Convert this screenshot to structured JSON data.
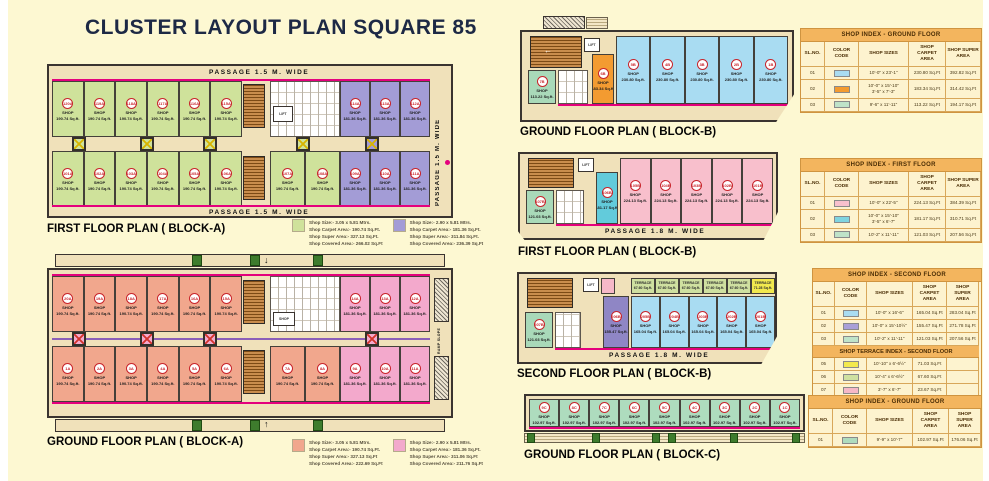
{
  "page": {
    "title": "CLUSTER LAYOUT PLAN SQUARE 85"
  },
  "labels": {
    "shop_word": "SHOP",
    "terrace_word": "TERRACE",
    "lift": "LIFT",
    "arrow_down": "↓",
    "arrow_up": "↑",
    "arrow_left": "←"
  },
  "colors": {
    "green_a": "#cfe29b",
    "purple_a": "#a39cd6",
    "salmon": "#f1a78d",
    "pink_a": "#f3a9cc",
    "blue_b": "#a9dcf2",
    "orange_b": "#f39b31",
    "mint": "#a9d9b9",
    "pink_b": "#f8bfcc",
    "cyan_b": "#62cbdb",
    "purple_b": "#8f86c5",
    "terr_green": "#cfe0a0",
    "terr_yellow": "#f2e94e",
    "terr_pink": "#f6b8c8",
    "mint_c": "#aedcbe",
    "magenta": "#e4007d"
  },
  "plans": {
    "first_a": {
      "label": "FIRST FLOOR PLAN ( BLOCK-A)",
      "passage_top": "PASSAGE 1.5 M. WIDE",
      "passage_bottom": "PASSAGE 1.5 M. WIDE",
      "passage_side": "PASSAGE 1.5 M. WIDE",
      "green_top": [
        "120A",
        "119A",
        "118A",
        "117A",
        "116A",
        "115A"
      ],
      "green_bottom": [
        "101A",
        "102A",
        "103A",
        "104A",
        "105A",
        "106A"
      ],
      "green_mid": [
        "107A",
        "108A"
      ],
      "purple_top": [
        "114A",
        "113A",
        "112A"
      ],
      "purple_bottom": [
        "109A",
        "110A",
        "111A"
      ],
      "green_area": "190.74 Sq.ft.",
      "purple_area": "181.36 Sq.ft."
    },
    "ground_a": {
      "label": "GROUND FLOOR PLAN ( BLOCK-A)",
      "salmon_top": [
        "20A",
        "19A",
        "18A",
        "17A",
        "16A",
        "15A"
      ],
      "salmon_bottom": [
        "1A",
        "2A",
        "3A",
        "4A",
        "5A",
        "6A"
      ],
      "salmon_mid": [
        "7A",
        "8A"
      ],
      "pink_top": [
        "14A",
        "13A",
        "12A"
      ],
      "pink_bottom": [
        "9A",
        "10A",
        "11A"
      ],
      "salmon_area": "190.74 Sq.ft.",
      "pink_area": "181.36 Sq.ft.",
      "small_shop_label": "SHOP",
      "ramp_label": "RAMP SLOPE"
    },
    "ground_b": {
      "label": "GROUND FLOOR PLAN ( BLOCK-B)",
      "mint_shop": {
        "id": "7B",
        "area": "113.22 Sq.ft."
      },
      "orange_shop": {
        "id": "6B",
        "area": "183.34 Sq.ft."
      },
      "blue_shops": [
        "5B",
        "4B",
        "3B",
        "2B",
        "1B"
      ],
      "blue_area": "230.80 Sq.ft."
    },
    "first_b": {
      "label": "FIRST FLOOR PLAN ( BLOCK-B)",
      "passage": "PASSAGE 1.8 M. WIDE",
      "mint_shop": {
        "id": "107B",
        "area": "121.03 Sq.ft."
      },
      "cyan_shop": {
        "id": "106B",
        "area": "181.17 Sq.ft."
      },
      "pink_shops": [
        "105B",
        "104B",
        "103B",
        "102B",
        "101B"
      ],
      "pink_area": "224.13 Sq.ft."
    },
    "second_b": {
      "label": "SECOND FLOOR PLAN ( BLOCK-B)",
      "passage": "PASSAGE 1.8 M. WIDE",
      "mint_shop": {
        "id": "207B",
        "area": "121.03 Sq.ft."
      },
      "purple_shop": {
        "id": "206B",
        "area": "155.47 Sq.ft."
      },
      "blue_shops": [
        "205B",
        "204B",
        "203B",
        "202B",
        "201B"
      ],
      "blue_area": "165.04 Sq.ft.",
      "terrace_area": "67.60 Sq.ft.",
      "terrace_yellow_area": "71.28 Sq.ft."
    },
    "ground_c": {
      "label": "GROUND FLOOR PLAN ( BLOCK-C)",
      "shops": [
        "9C",
        "8C",
        "7C",
        "6C",
        "5C",
        "4C",
        "3C",
        "2C",
        "1C"
      ],
      "area": "102.97 Sq.ft."
    }
  },
  "legends": {
    "first_a": [
      {
        "swatch": "#cfe29b",
        "lines": [
          "Shop Size:- 3.05 x 5.81 Mtrs.",
          "Shop Carpet Area:- 190.74 Sq.Ft.",
          "Shop Super Area:- 327.13 Sq.Ft.",
          "Shop Covered Area:- 266.02 Sq.Ft"
        ]
      },
      {
        "swatch": "#a39cd6",
        "lines": [
          "Shop Size:- 2.90 x 5.81 Mtrs.",
          "Shop Carpet Area:- 181.36 Sq.Ft.",
          "Shop Super Area:- 311.84 Sq.Ft.",
          "Shop Covered Area:- 236.39 Sq.Ft"
        ]
      }
    ],
    "ground_a": [
      {
        "swatch": "#f1a78d",
        "lines": [
          "Shop Size:- 3.05 x 5.81 Mtrs.",
          "Shop Carpet Area:- 190.74 Sq.Ft.",
          "Shop Super Area:- 327.13 Sq.Ft",
          "Shop Covered Area:- 222.69 Sq.Ft"
        ]
      },
      {
        "swatch": "#f3a9cc",
        "lines": [
          "Shop Size:- 2.90 x 5.81 Mtrs.",
          "Shop Carpet Area:- 181.36 Sq.Ft.",
          "Shop Super Area:- 311.06 Sq.Ft",
          "Shop Covered Area:- 211.76 Sq.Ft"
        ]
      }
    ]
  },
  "tables": [
    {
      "id": "tbl1",
      "title": "SHOP INDEX - GROUND FLOOR",
      "headers": [
        "SL.NO.",
        "COLOR CODE",
        "SHOP SIZES",
        "SHOP CARPET AREA",
        "SHOP SUPER AREA"
      ],
      "rows": [
        {
          "no": "01",
          "swatch": "#a9dcf2",
          "size": "10'-0\" x 23'-1\"",
          "carpet": "230.80 Sq.Ft",
          "super": "392.82 Sq.Ft"
        },
        {
          "no": "02",
          "swatch": "#f39b31",
          "size": "10'-0\" x 15'-10\"\n3'-5\" x 7'-3\"",
          "carpet": "183.34 Sq.Ft",
          "super": "314.42 Sq.Ft"
        },
        {
          "no": "03",
          "swatch": "#bfe3c9",
          "size": "9'-6\" x 11'-11\"",
          "carpet": "113.22 Sq.Ft",
          "super": "194.17 Sq.Ft"
        }
      ]
    },
    {
      "id": "tbl2",
      "title": "SHOP INDEX - FIRST FLOOR",
      "headers": [
        "SL.NO.",
        "COLOR CODE",
        "SHOP SIZES",
        "SHOP CARPET AREA",
        "SHOP SUPER AREA"
      ],
      "rows": [
        {
          "no": "01",
          "swatch": "#f8c0cd",
          "size": "10'-0\" x 22'-5\"",
          "carpet": "224.13 Sq.Ft",
          "super": "384.39 Sq.Ft"
        },
        {
          "no": "02",
          "swatch": "#7fd4e0",
          "size": "10'-0\" x 15'-10\"\n3'-5\" x 6'-7\"",
          "carpet": "181.17 Sq.Ft",
          "super": "310.71 Sq.Ft"
        },
        {
          "no": "03",
          "swatch": "#bfe3c9",
          "size": "10'-2\" x 11'-11\"",
          "carpet": "121.03 Sq.Ft",
          "super": "207.56 Sq.Ft"
        }
      ]
    },
    {
      "id": "tbl3",
      "title": "SHOP INDEX - SECOND FLOOR",
      "headers": [
        "SL.NO.",
        "COLOR CODE",
        "SHOP SIZES",
        "SHOP CARPET AREA",
        "SHOP SUPER AREA"
      ],
      "rows": [
        {
          "no": "01",
          "swatch": "#a9dcf2",
          "size": "10'-0\" x 16'-6\"",
          "carpet": "165.04 Sq.Ft",
          "super": "283.04 Sq.Ft"
        },
        {
          "no": "02",
          "swatch": "#a9a0d8",
          "size": "10'-0\" x 15'-10½\"",
          "carpet": "155.47 Sq.Ft",
          "super": "271.78 Sq.Ft"
        },
        {
          "no": "03",
          "swatch": "#bfe3c9",
          "size": "10'-2\" x 11'-11\"",
          "carpet": "121.03 Sq.Ft",
          "super": "207.56 Sq.Ft"
        },
        {
          "subheader": "SHOP TERRACE INDEX - SECOND FLOOR"
        },
        {
          "no": "05",
          "swatch": "#f2e94e",
          "size": "10'-10\" x 6'-6½\"",
          "carpet": "71.03 Sq.Ft",
          "super": ""
        },
        {
          "no": "06",
          "swatch": "#cfe0a0",
          "size": "10'-4\" x 6'-6½\"",
          "carpet": "67.60 Sq.Ft",
          "super": ""
        },
        {
          "no": "07",
          "swatch": "#f6b8c8",
          "size": "3'-7\" x 6'-7\"",
          "carpet": "23.67 Sq.Ft",
          "super": ""
        }
      ]
    },
    {
      "id": "tbl4",
      "title": "SHOP INDEX - GROUND FLOOR",
      "headers": [
        "SL.NO.",
        "COLOR CODE",
        "SHOP SIZES",
        "SHOP CARPET AREA",
        "SHOP SUPER AREA"
      ],
      "rows": [
        {
          "no": "01",
          "swatch": "#aedcbe",
          "size": "9'-9\" x 10'-7\"",
          "carpet": "102.97 Sq.Ft",
          "super": "176.06 Sq.Ft"
        }
      ]
    }
  ]
}
